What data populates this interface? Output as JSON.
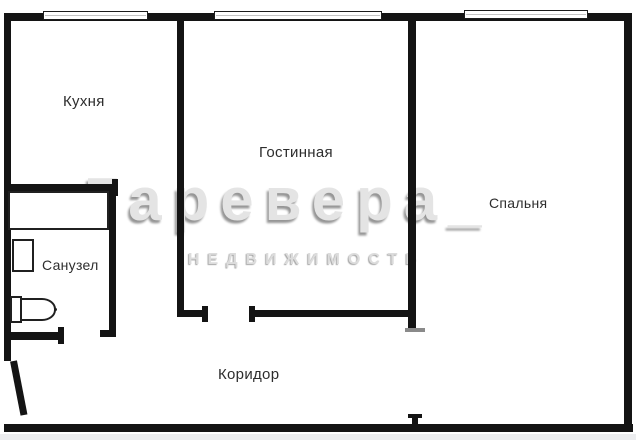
{
  "rooms": {
    "kitchen": "Кухня",
    "living": "Гостинная",
    "bedroom": "Спальня",
    "bathroom": "Санузел",
    "corridor": "Коридор"
  },
  "watermark": {
    "brand": "Гаревера_",
    "subtitle": "НЕДВИЖИМОСТЬ"
  },
  "colors": {
    "wall": "#141414",
    "label": "#2d2d2d",
    "watermark_fill": "#e4e4e4",
    "watermark_shadow": "#969696",
    "jamb_gray": "#8a8a8a",
    "background": "#ffffff"
  }
}
